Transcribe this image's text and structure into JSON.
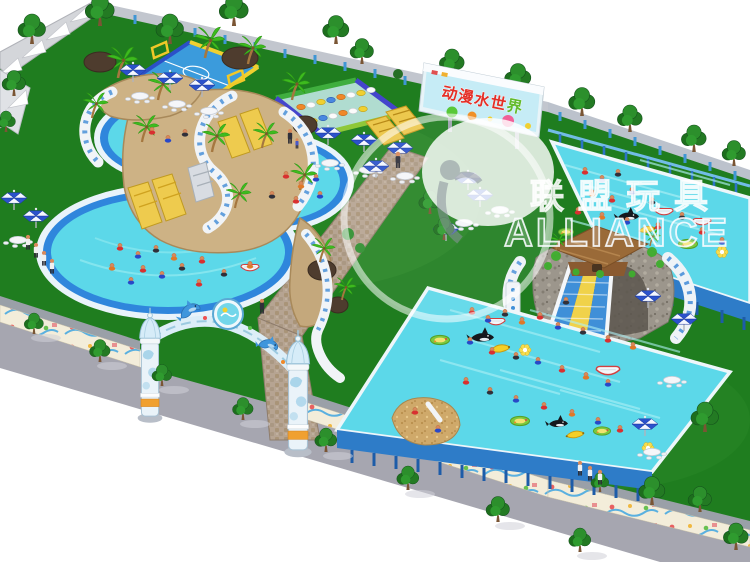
{
  "meta": {
    "scene_title": "Aerial 3D render of an inflatable mobile water park"
  },
  "billboard": {
    "text_main": "动漫水世",
    "text_accent": "界"
  },
  "watermark": {
    "cn": "联盟玩具",
    "en": "ALLIANCE"
  },
  "palette": {
    "grass": "#1f7d1f",
    "water": "#5cd8e9",
    "rim": "#2f86dc",
    "sidewalk": "#a6a6b0",
    "frameside": "#2e7cc8",
    "slideyellow": "#eecb4e"
  },
  "features": [
    "entrance-arch",
    "soccer-field",
    "stepping-stones-course",
    "round-pool-small",
    "round-pool-mid",
    "round-pool-large",
    "slide-mountain",
    "frame-pool-top",
    "frame-pool-main",
    "arch-slide",
    "billboard",
    "mural-wall",
    "shade-sail-wall",
    "picnic-umbrellas",
    "picnic-tables",
    "stone-path",
    "perimeter-trees",
    "palm-trees",
    "swimmers",
    "float-toys"
  ]
}
